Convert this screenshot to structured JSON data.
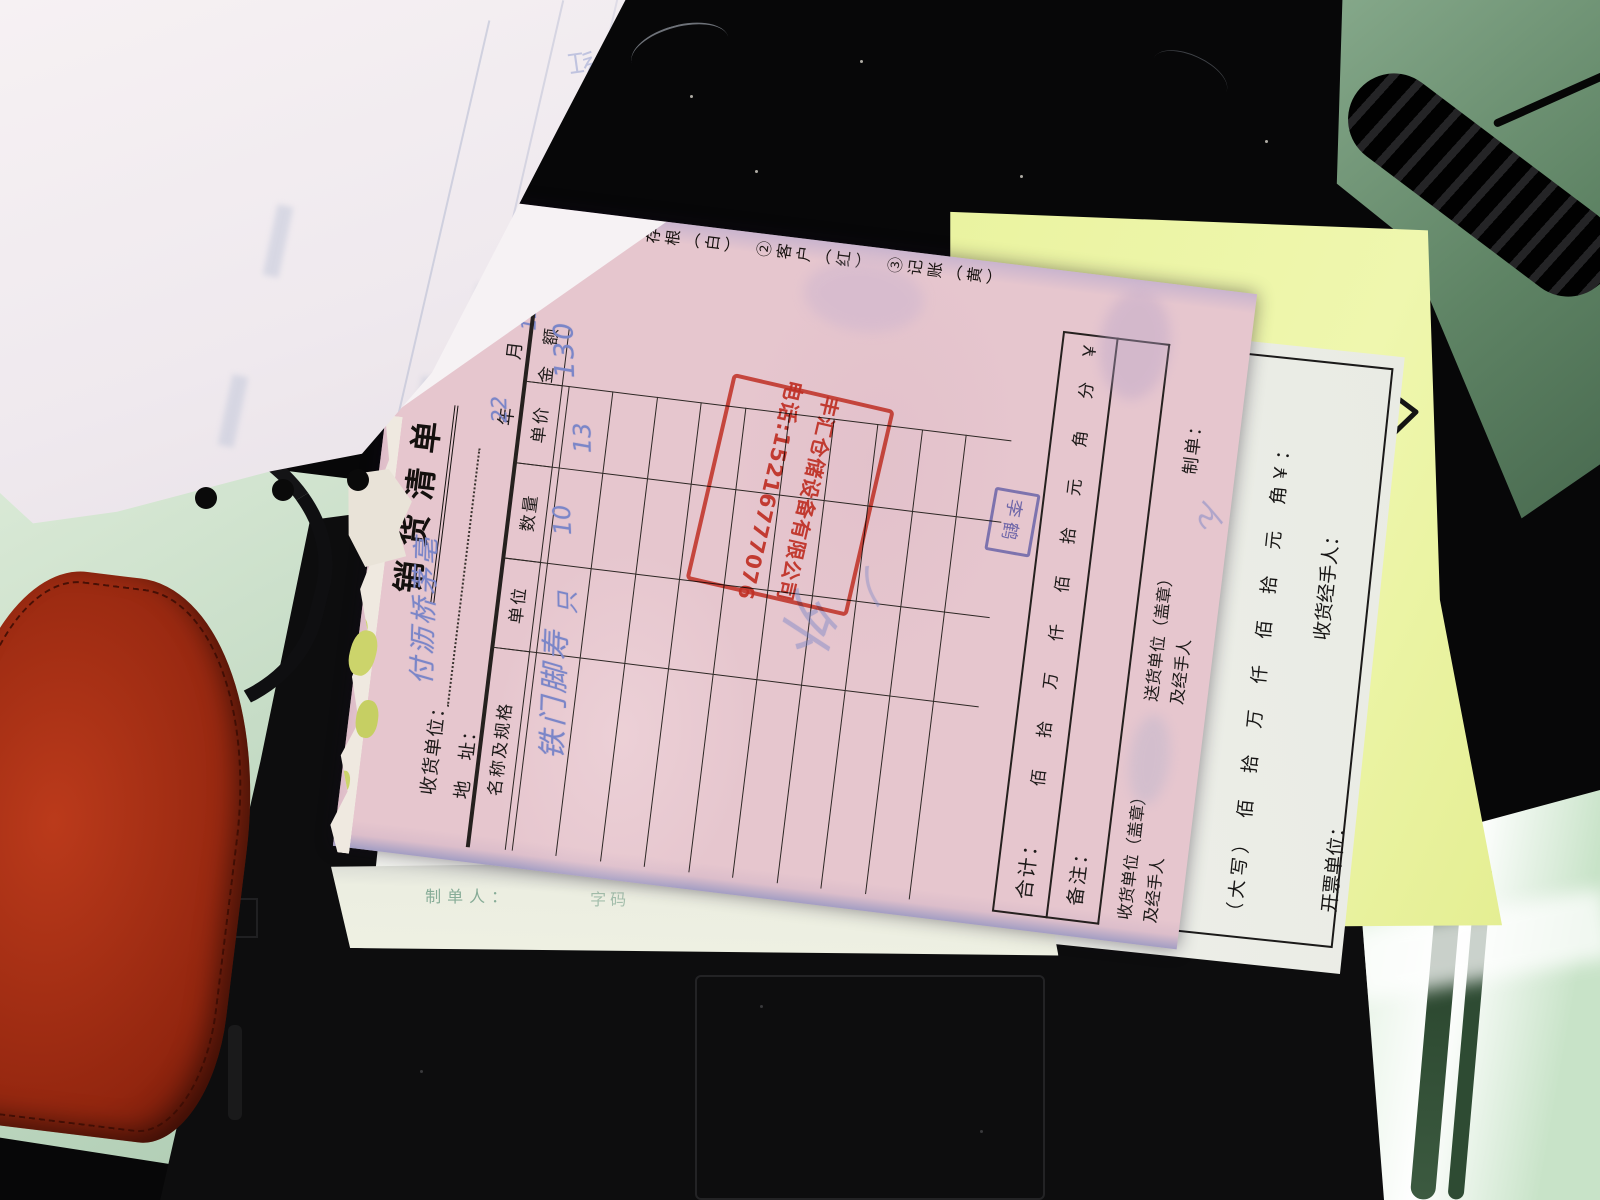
{
  "form": {
    "copy_labels": "①存根（白）　②客户（红）　③记账（黄）",
    "title": "销货清单",
    "consignee_label": "收货单位：",
    "address_label": "地　址：",
    "date_year": "年",
    "date_month": "月",
    "date_day": "日",
    "table_headers": [
      "名称及规格",
      "单位",
      "数量",
      "单价",
      "金　额"
    ],
    "total_label": "合计：",
    "digits": [
      "佰",
      "拾",
      "万",
      "仟",
      "佰",
      "拾",
      "元",
      "角",
      "分"
    ],
    "yuan_sign": "￥",
    "remark_label": "备注：",
    "receiver_stamp_line1": "收货单位（盖章）",
    "receiver_stamp_line2": "及经手人",
    "sender_stamp_line1": "送货单位（盖章）",
    "sender_stamp_line2": "及经手人",
    "maker_label": "制单：",
    "handwriting": {
      "consignee": "付沥桥茅亳",
      "year_value": "22",
      "month_value": "12",
      "item_name": "铁门脚寿",
      "unit": "只",
      "qty": "10",
      "price": "13",
      "amount": "130",
      "scribbles": [
        "外",
        "ノ",
        "ん"
      ]
    },
    "red_stamp": {
      "company": "丰汇仓储设备有限公司",
      "phone": "电话:15216777076"
    },
    "blue_stamp": "李鹤"
  },
  "white_copy": {
    "caps_line": "（大写）　佰　拾　万　仟　佰　拾　元　角￥：",
    "receiver": "收货经手人：",
    "issuer": "开票单位：",
    "slogan": "客户至上"
  },
  "under_sheet": {
    "maker": "制单人：",
    "maker_value": "字码"
  },
  "ghost": {
    "char": "红"
  },
  "colors": {
    "form_pink": "#e6c6ce",
    "copy_yellow": "#e9f29e",
    "stamp_red": "#d53c2b",
    "chop_blue": "#5a66c6",
    "ink_blue": "#7b86c8",
    "desk_green": "#b7d2ba",
    "case_red": "#a52d12"
  }
}
